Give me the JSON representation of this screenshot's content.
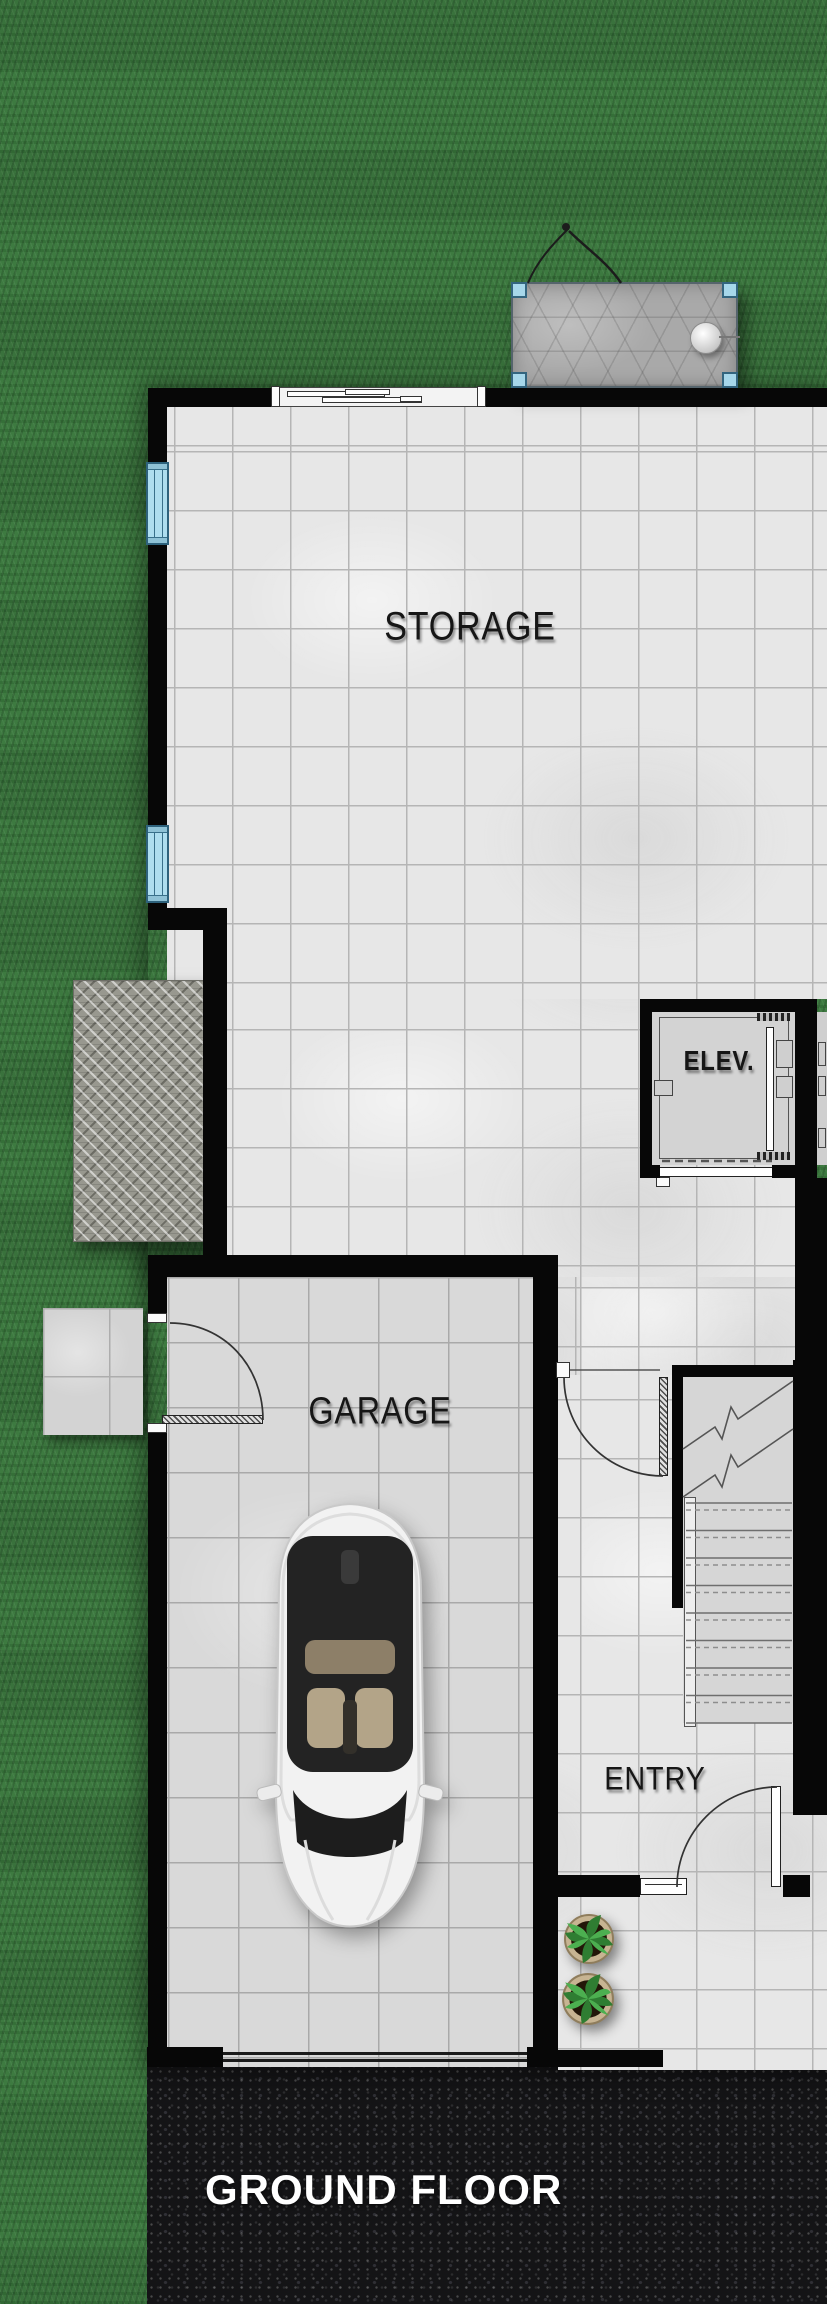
{
  "plan": {
    "title": "GROUND FLOOR",
    "rooms": {
      "storage": {
        "label": "STORAGE"
      },
      "garage": {
        "label": "GARAGE"
      },
      "entry": {
        "label": "ENTRY"
      },
      "elevator": {
        "label": "ELEV."
      }
    },
    "objects": {
      "car": "white-sedan-top-view",
      "plants": "potted-plant x2",
      "patio": "stone-paver-pad",
      "mat": "diamond-plate-mat",
      "stoop": "concrete-side-stoop",
      "stairs": "staircase-8-treads-up",
      "garage_door": "garage-door",
      "windows": "west-wall-window x2",
      "sliding_door": "north-wall-sliding-door"
    },
    "colors": {
      "grass": "#3d7a40",
      "wall": "#070707",
      "tile_light": "#e7e7e7",
      "tile_garage": "#d9d9d9",
      "asphalt": "#141416",
      "window_blue": "#aedeef",
      "label_dark": "#161616",
      "label_light": "#ffffff"
    }
  }
}
